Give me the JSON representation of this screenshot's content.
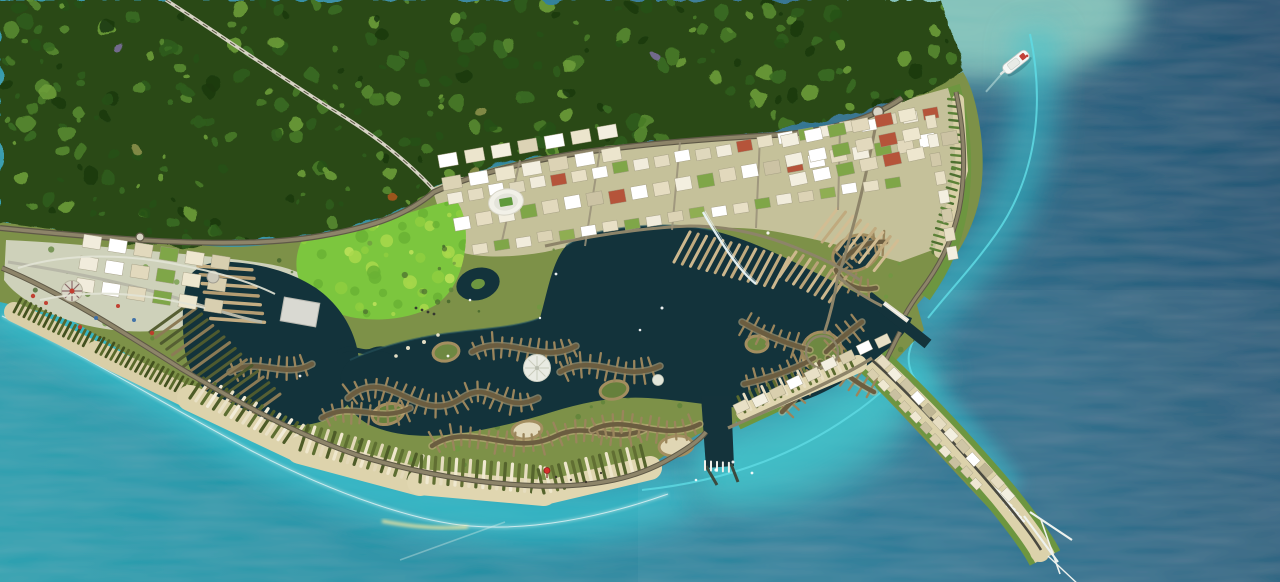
{
  "scene": {
    "label": "Aerial rendering of a coastal resort masterplan with forest, lagoon, canal islands, marinas, golf course, theme park, beachfront strip and a ferry boat at sea"
  },
  "palette": {
    "sea_deep": "#174e6e",
    "sea_mid": "#1f7492",
    "sea_teal": "#1b8ca2",
    "sea_bright": "#21a0af",
    "shore_glow": "#38c6d2",
    "bay_glow": "#3dc2c9",
    "shallow_line": "#5fdbe4",
    "foam": "#9fe0cd",
    "lagoon": "#13333b",
    "lagoon_edge": "#2a5a64",
    "water_channel": "#14333b",
    "forest_base": "#2a4a16",
    "land_base": "#7d9148",
    "park_green": "#6d9640",
    "golf_green": "#7cc63e",
    "sand": "#dcd2ab",
    "beach_bright": "#e6ddb8",
    "urban_ground": "#c9c49f",
    "park_ground": "#ced1ba",
    "road": "#8d8469",
    "road_dark": "#5f5947",
    "road_light": "#d6d2c4",
    "road_center": "#55503f",
    "bridge": "#e9f6f8",
    "white": "#f4f6f2",
    "stadium_white": "#f2f1e8",
    "pitch_green": "#5f9a3c",
    "ring_edge": "#a38e60",
    "island_spine": "#6b5d40",
    "island_rib": "#9a855c",
    "island_under": "#c9b185",
    "boat_white": "#f6f8f6",
    "boat_red": "#c24038",
    "marker_red": "#d5312c"
  },
  "features": {
    "scatters": [
      {
        "layer": "forest-tex",
        "x": 0,
        "y": 0,
        "w": 975,
        "h": 258,
        "count": 430,
        "rmin": 2,
        "rmax": 8,
        "opacity": 0.9,
        "colors": [
          "#1c3a10",
          "#275117",
          "#2f5c1b",
          "#3a6c22",
          "#477a28",
          "#568a30",
          "#6b9c3a"
        ]
      },
      {
        "layer": "forest-tex",
        "x": 60,
        "y": 40,
        "w": 700,
        "h": 180,
        "count": 7,
        "rmin": 3,
        "rmax": 5,
        "opacity": 0.9,
        "colors": [
          "#a8551f",
          "#7a6f9a",
          "#8a8f4a"
        ]
      },
      {
        "layer": "golf-mottle",
        "x": 295,
        "y": 200,
        "w": 175,
        "h": 115,
        "count": 60,
        "rmin": 2,
        "rmax": 7,
        "opacity": 0.85,
        "colors": [
          "#a9d84b",
          "#8fce3f",
          "#6ab234",
          "#bfe25a"
        ]
      },
      {
        "layer": "land-trees",
        "x": 10,
        "y": 235,
        "w": 950,
        "h": 280,
        "count": 170,
        "rmin": 1.2,
        "rmax": 3.2,
        "opacity": 0.75,
        "colors": [
          "#4e7030",
          "#5d8338",
          "#6f9a42",
          "#3f6128"
        ]
      }
    ],
    "combs": [
      {
        "x1": 690,
        "y1": 232,
        "x2": 790,
        "y2": 258,
        "ang": 118,
        "len": 34,
        "gap": 8.5,
        "w": 3,
        "colors": [
          "#cdb88e",
          "#c0aa7e"
        ]
      },
      {
        "x1": 796,
        "y1": 252,
        "x2": 848,
        "y2": 278,
        "ang": 124,
        "len": 30,
        "gap": 8,
        "w": 3,
        "colors": [
          "#cdb88e",
          "#b8a278"
        ]
      },
      {
        "x1": 838,
        "y1": 208,
        "x2": 900,
        "y2": 242,
        "ang": 128,
        "len": 38,
        "gap": 8.5,
        "w": 3,
        "colors": [
          "#d2bd93",
          "#c0aa7e"
        ]
      },
      {
        "x1": 150,
        "y1": 332,
        "x2": 240,
        "y2": 424,
        "ang": -36,
        "len": 50,
        "gap": 8,
        "w": 3,
        "colors": [
          "#565f33",
          "#8b7b55",
          "#4e5a2e"
        ]
      },
      {
        "x1": 198,
        "y1": 266,
        "x2": 212,
        "y2": 324,
        "ang": 4,
        "len": 54,
        "gap": 9,
        "w": 3.4,
        "colors": [
          "#c4ad82",
          "#b49c72"
        ]
      },
      {
        "x1": 1002,
        "y1": 494,
        "x2": 1026,
        "y2": 524,
        "ang": 216,
        "len": 13,
        "gap": 5,
        "w": 2.4,
        "colors": [
          "#f2f4f0"
        ]
      },
      {
        "x1": 14,
        "y1": 312,
        "x2": 96,
        "y2": 352,
        "ang": -62,
        "len": 15,
        "gap": 5.5,
        "w": 2.8,
        "colors": [
          "#43511f",
          "#57682c"
        ],
        "base": {
          "color": "#d9cfa8",
          "w": 20
        }
      },
      {
        "x1": 96,
        "y1": 352,
        "x2": 190,
        "y2": 398,
        "ang": -60,
        "len": 16,
        "gap": 5.5,
        "w": 2.8,
        "colors": [
          "#43511f",
          "#5a6a2c"
        ],
        "base": {
          "color": "#d9cfa8",
          "w": 22
        }
      },
      {
        "x1": 190,
        "y1": 398,
        "x2": 300,
        "y2": 450,
        "ang": -56,
        "len": 24,
        "gap": 6.5,
        "w": 3.2,
        "colors": [
          "#4e5c28",
          "#e9e1c6",
          "#5d6e31",
          "#f2ecd8"
        ],
        "base": {
          "color": "#ddd3ac",
          "w": 26
        }
      },
      {
        "x1": 300,
        "y1": 450,
        "x2": 420,
        "y2": 482,
        "ang": -72,
        "len": 26,
        "gap": 7,
        "w": 3.2,
        "colors": [
          "#4e5c28",
          "#efe7cc",
          "#5d6e31",
          "#e2d8b8"
        ],
        "base": {
          "color": "#ddd3ac",
          "w": 28
        }
      },
      {
        "x1": 420,
        "y1": 482,
        "x2": 544,
        "y2": 493,
        "ang": -86,
        "len": 26,
        "gap": 7,
        "w": 3.2,
        "colors": [
          "#55642d",
          "#f0e9d0",
          "#616f33",
          "#e6ddbf"
        ],
        "base": {
          "color": "#e0d6b0",
          "w": 26
        }
      },
      {
        "x1": 544,
        "y1": 493,
        "x2": 650,
        "y2": 468,
        "ang": -104,
        "len": 24,
        "gap": 7,
        "w": 3.2,
        "colors": [
          "#55642d",
          "#eee6cb",
          "#616f33"
        ],
        "base": {
          "color": "#e0d6b0",
          "w": 24
        }
      },
      {
        "x1": 745,
        "y1": 412,
        "x2": 858,
        "y2": 364,
        "ang": -115,
        "len": 17,
        "gap": 6.5,
        "w": 2.8,
        "colors": [
          "#5a6a2e",
          "#e8dfc2",
          "#66763a"
        ],
        "base": {
          "color": "#e0d6b0",
          "w": 18
        }
      },
      {
        "x1": 705,
        "y1": 461,
        "x2": 731,
        "y2": 463,
        "ang": 90,
        "len": 9,
        "gap": 6,
        "w": 2,
        "colors": [
          "#eef0ea"
        ]
      },
      {
        "x1": 958,
        "y1": 100,
        "x2": 962,
        "y2": 170,
        "ang": 186,
        "len": 10,
        "gap": 7,
        "w": 2.4,
        "colors": [
          "#5d8338",
          "#4e7030"
        ],
        "base": {
          "color": "#d9cfa8",
          "w": 12
        }
      },
      {
        "x1": 962,
        "y1": 170,
        "x2": 940,
        "y2": 252,
        "ang": 196,
        "len": 10,
        "gap": 7,
        "w": 2.4,
        "colors": [
          "#5d8338",
          "#4e7030"
        ],
        "base": {
          "color": "#d9cfa8",
          "w": 12
        }
      }
    ],
    "spines": [
      {
        "d": "M348,398 C388,362 418,428 462,398 C492,378 502,416 538,398"
      },
      {
        "d": "M432,446 C470,420 512,458 556,436 C590,420 612,446 648,428"
      },
      {
        "d": "M472,352 C508,332 540,366 576,346"
      },
      {
        "d": "M560,372 C596,352 622,384 660,366"
      },
      {
        "d": "M592,430 C628,412 660,444 700,424"
      },
      {
        "d": "M742,322 C766,336 788,344 810,350"
      },
      {
        "d": "M744,384 C770,378 794,370 814,358"
      },
      {
        "d": "M782,412 C800,394 812,378 820,362"
      },
      {
        "d": "M862,322 C846,334 834,344 826,352"
      },
      {
        "d": "M874,392 C854,382 840,370 828,358"
      },
      {
        "d": "M836,270 C846,252 866,240 886,242"
      },
      {
        "d": "M836,270 C842,284 858,292 876,288"
      },
      {
        "d": "M230,372 C258,356 284,380 312,364"
      },
      {
        "d": "M322,418 C352,400 380,424 410,408"
      }
    ],
    "spine_style": {
      "rib": 11,
      "gap": 9,
      "sw": 4.5,
      "rw": 2.3
    },
    "rings": [
      [
        388,
        414,
        16,
        10,
        -15,
        "#66803c"
      ],
      [
        446,
        352,
        13,
        9,
        -10,
        "#6e8842"
      ],
      [
        527,
        430,
        15,
        9,
        -8,
        "#e3dabc"
      ],
      [
        614,
        390,
        14,
        9,
        -12,
        "#66803c"
      ],
      [
        676,
        446,
        17,
        10,
        -6,
        "#e0d6b4"
      ],
      [
        757,
        344,
        11,
        8,
        0,
        "#6e8842"
      ],
      [
        856,
        253,
        24,
        17,
        -22,
        "#15363e"
      ],
      [
        822,
        352,
        20,
        20,
        0,
        "#6e8842"
      ]
    ],
    "blockrows": [
      {
        "x": 455,
        "y": 197,
        "ang": -10,
        "n": 24,
        "w": 15,
        "h": 11,
        "gap": 6,
        "colors": [
          "#f1ecdc",
          "#e4dcc2",
          "#ffffff",
          "#dfd8bd",
          "#f1ecdc",
          "#b5543a",
          "#e8e0c6",
          "#ffffff",
          "#7fa648"
        ]
      },
      {
        "x": 462,
        "y": 223,
        "ang": -10,
        "n": 23,
        "w": 16,
        "h": 13,
        "gap": 6.5,
        "colors": [
          "#ffffff",
          "#e6ddc2",
          "#f3efe0",
          "#7fa648",
          "#e2d9bd",
          "#ffffff",
          "#ccc3a4",
          "#b5543a"
        ]
      },
      {
        "x": 480,
        "y": 248,
        "ang": -9,
        "n": 20,
        "w": 15,
        "h": 10,
        "gap": 7,
        "colors": [
          "#e8e0c6",
          "#7fa648",
          "#f1ecdc",
          "#dcd3b5",
          "#8fae52",
          "#ffffff"
        ]
      },
      {
        "x": 742,
        "y": 408,
        "ang": -26,
        "n": 9,
        "w": 14,
        "h": 10,
        "gap": 5.5,
        "colors": [
          "#e8e0c6",
          "#f3efe0",
          "#d9cfae",
          "#ffffff"
        ]
      },
      {
        "x": 884,
        "y": 362,
        "ang": 47,
        "n": 12,
        "w": 12,
        "h": 9,
        "gap": 4.5,
        "colors": [
          "#e6ddc2",
          "#f3efe0",
          "#cfc6a6",
          "#ffffff",
          "#bfb694"
        ]
      },
      {
        "x": 874,
        "y": 374,
        "ang": 47,
        "n": 11,
        "w": 10,
        "h": 8,
        "gap": 5,
        "colors": [
          "#d9cfae",
          "#efe8d2",
          "#c9c0a0"
        ]
      },
      {
        "x": 930,
        "y": 122,
        "ang": 80,
        "n": 8,
        "w": 13,
        "h": 10,
        "gap": 6,
        "colors": [
          "#e8e0c6",
          "#f3efe0",
          "#d2c9a9"
        ]
      }
    ],
    "grids": [
      {
        "x": 92,
        "y": 242,
        "ang": 9,
        "cols": 6,
        "rows": 3,
        "w": 18,
        "h": 13,
        "gx": 8,
        "gy": 9,
        "colors": [
          "#f1ecdc",
          "#ffffff",
          "#e2d9bd",
          "#7fa648",
          "#eee7cf",
          "#d8cfb0"
        ]
      },
      {
        "x": 448,
        "y": 160,
        "ang": -10,
        "cols": 7,
        "rows": 2,
        "w": 19,
        "h": 13,
        "gx": 8,
        "gy": 10,
        "colors": [
          "#ffffff",
          "#ece5cd",
          "#f3efe0",
          "#dcd3b5"
        ]
      },
      {
        "x": 790,
        "y": 140,
        "ang": -12,
        "cols": 6,
        "rows": 3,
        "w": 17,
        "h": 12,
        "gx": 7,
        "gy": 8,
        "colors": [
          "#f3efe0",
          "#ffffff",
          "#7fa648",
          "#e2d9bd",
          "#b5543a",
          "#eee7cf"
        ]
      }
    ],
    "dots": [
      {
        "layer": "dots",
        "color": "#ffffff",
        "opacity": 0.92,
        "items": [
          [
            768,
            233,
            1.6
          ],
          [
            662,
            308,
            1.5
          ],
          [
            556,
            274,
            1.4
          ],
          [
            470,
            300,
            1.3
          ],
          [
            448,
            356,
            1.4
          ],
          [
            300,
            376,
            1.4
          ],
          [
            640,
            330,
            1.3
          ],
          [
            540,
            318,
            1.2
          ]
        ]
      },
      {
        "layer": "dots",
        "color": "#ffffff",
        "opacity": 0.9,
        "items": [
          [
            716,
            470,
            1.6
          ],
          [
            733,
            462,
            1.5
          ],
          [
            752,
            473,
            1.4
          ],
          [
            696,
            480,
            1.3
          ]
        ]
      },
      {
        "layer": "dots",
        "color": "#3a342a",
        "opacity": 0.95,
        "items": [
          [
            556,
            477,
            1.2
          ],
          [
            571,
            480,
            1.2
          ],
          [
            586,
            482,
            1.2
          ],
          [
            601,
            473,
            1.1
          ]
        ]
      },
      {
        "layer": "dots",
        "color": "#efe8cc",
        "opacity": 0.95,
        "items": [
          [
            408,
            348,
            2
          ],
          [
            424,
            342,
            2
          ],
          [
            396,
            356,
            1.8
          ],
          [
            438,
            335,
            1.8
          ]
        ]
      },
      {
        "layer": "dots",
        "color": "#c0392b",
        "opacity": 0.95,
        "items": [
          [
            33,
            296,
            2.2
          ],
          [
            46,
            303,
            2
          ],
          [
            80,
            327,
            2.2
          ],
          [
            118,
            306,
            2
          ],
          [
            152,
            333,
            2.2
          ]
        ]
      },
      {
        "layer": "dots",
        "color": "#3a6ea8",
        "opacity": 0.95,
        "items": [
          [
            96,
            318,
            2
          ],
          [
            134,
            320,
            2
          ]
        ]
      },
      {
        "layer": "dots",
        "color": "#2e2e2e",
        "opacity": 0.9,
        "items": [
          [
            416,
            308,
            1.4
          ],
          [
            422,
            310,
            1.4
          ],
          [
            428,
            312,
            1.4
          ],
          [
            434,
            314,
            1.4
          ]
        ]
      }
    ]
  }
}
